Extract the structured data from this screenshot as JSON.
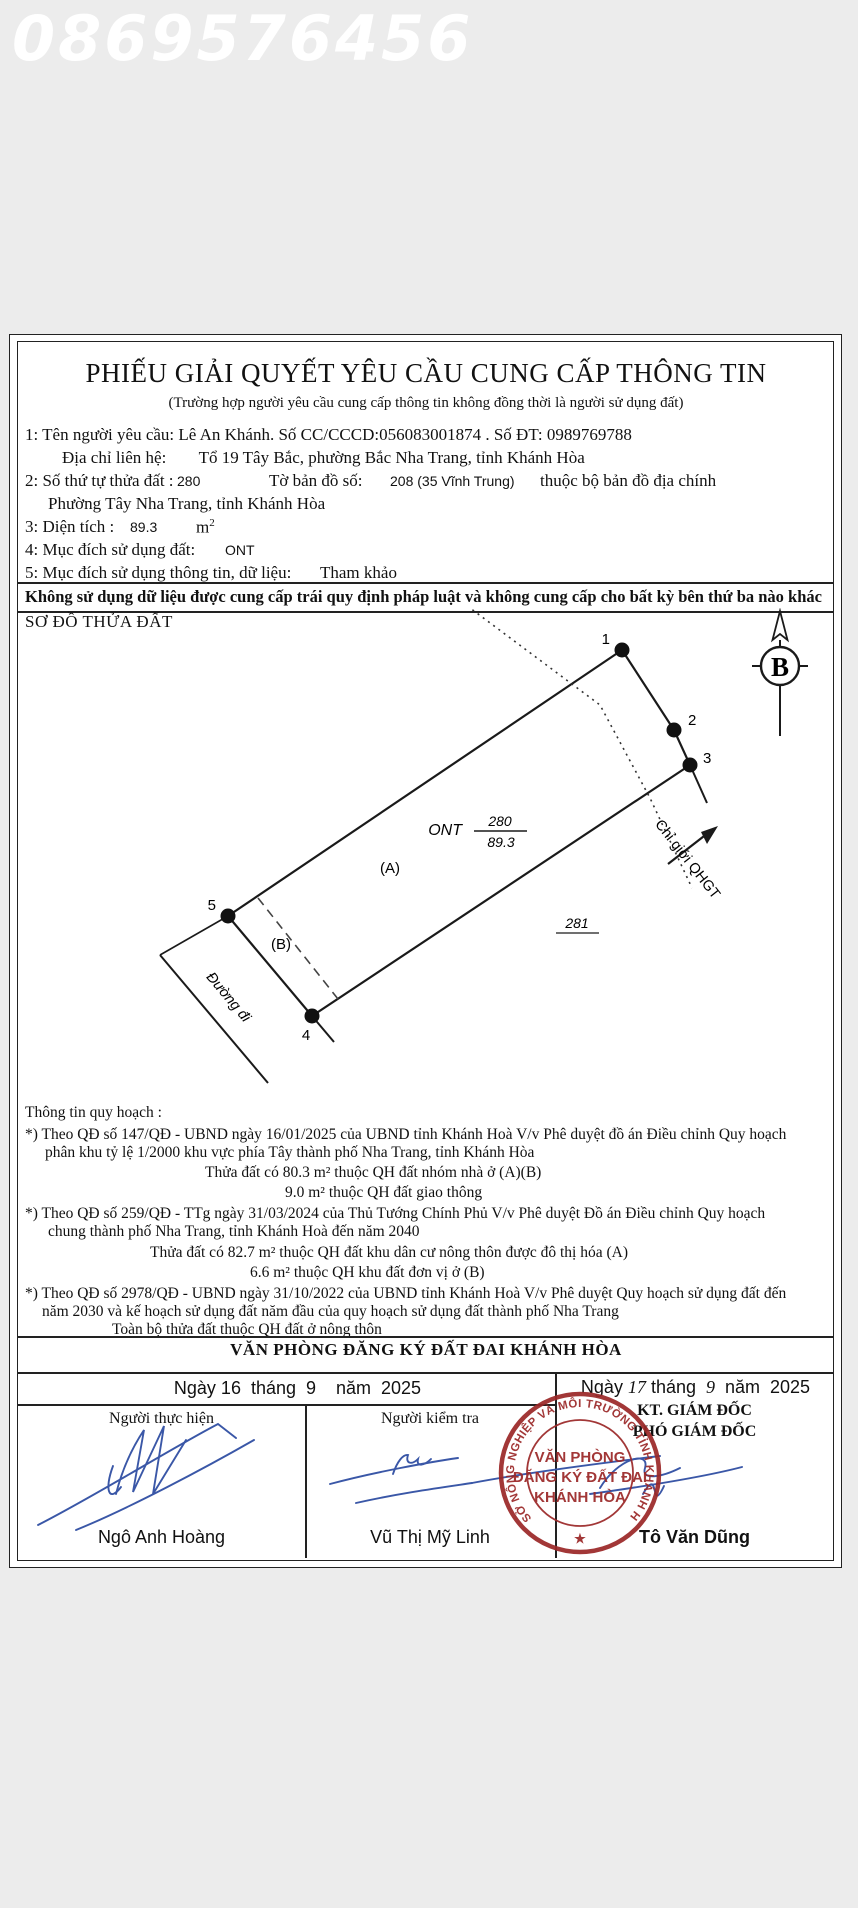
{
  "watermark": "0869576456",
  "doc": {
    "title": "PHIẾU GIẢI QUYẾT YÊU CẦU CUNG CẤP THÔNG TIN",
    "subtitle": "(Trường hợp người yêu cầu cung cấp thông tin không đồng thời là người sử dụng đất)",
    "fields": {
      "requester": "1: Tên người yêu cầu: Lê An Khánh. Số CC/CCCD:056083001874 . Số ĐT: 0989769788",
      "address_label": "Địa chỉ liên hệ:",
      "address_value": "Tổ 19 Tây Bắc, phường Bắc Nha Trang, tỉnh Khánh Hòa",
      "parcel_label": "2: Số thứ tự thửa đất :",
      "parcel_number": "280",
      "sheet_label": "Tờ bản đồ số:",
      "sheet_number": "208 (35 Vĩnh Trung)",
      "sheet_suffix": "thuộc bộ bản đồ địa chính",
      "parcel_address": "Phường Tây Nha Trang, tỉnh Khánh Hòa",
      "area_label": "3: Diện tích :",
      "area_value": "89.3",
      "area_unit": "m",
      "area_unit_sup": "2",
      "landuse_label": "4: Mục đích sử dụng đất:",
      "landuse_value": "ONT",
      "purpose_label": "5: Mục đích sử dụng thông tin, dữ liệu:",
      "purpose_value": "Tham khảo",
      "disclaimer": "Không sử dụng dữ liệu được cung cấp trái quy định pháp luật và không cung cấp cho bất kỳ bên thứ ba nào khác"
    },
    "diagram": {
      "heading": "SƠ ĐỒ THỬA ĐẤT",
      "north_label": "B",
      "point1": "1",
      "point2": "2",
      "point3": "3",
      "point4": "4",
      "point5": "5",
      "landuse_code": "ONT",
      "parcel_number": "280",
      "parcel_area": "89.3",
      "zone_a": "(A)",
      "zone_b": "(B)",
      "neighbor_parcel": "281",
      "boundary_label": "Chỉ giới QHGT",
      "road_label": "Đường đi"
    },
    "planning": {
      "heading": "Thông tin quy hoạch :",
      "lines": [
        "*) Theo QĐ số 147/QĐ - UBND ngày 16/01/2025 của UBND tỉnh Khánh Hoà V/v Phê duyệt đồ án Điều chỉnh Quy hoạch",
        "phân khu tỷ lệ 1/2000 khu vực phía Tây thành phố Nha Trang, tỉnh Khánh Hòa",
        "Thửa đất có 80.3 m² thuộc QH đất nhóm nhà ở (A)(B)",
        "9.0 m² thuộc QH đất giao thông",
        "*) Theo QĐ số 259/QĐ - TTg ngày 31/03/2024 của Thủ Tướng Chính Phủ V/v Phê duyệt Đồ án Điều chỉnh Quy hoạch",
        "chung thành phố Nha Trang, tỉnh Khánh Hoà đến năm 2040",
        "Thửa đất có 82.7 m² thuộc QH đất khu dân cư nông thôn được đô thị hóa (A)",
        "6.6 m² thuộc QH khu đất đơn vị ở (B)",
        "*) Theo QĐ số 2978/QĐ - UBND ngày 31/10/2022 của UBND tỉnh Khánh Hoà V/v Phê duyệt Quy hoạch sử dụng đất đến",
        "năm 2030 và kế hoạch sử dụng đất năm đầu của quy hoạch sử dụng đất thành phố Nha Trang",
        "Toàn bộ thửa đất thuộc QH đất ở nông thôn"
      ]
    },
    "footer": {
      "office": "VĂN PHÒNG ĐĂNG KÝ ĐẤT ĐAI KHÁNH HÒA",
      "date_left": "Ngày 16  tháng  9    năm  2025",
      "date_right_prefix": "Ngày ",
      "date_right_day": "17",
      "date_right_mid": " tháng  ",
      "date_right_month": "9",
      "date_right_suffix": "  năm  2025",
      "executor_title": "Người thực hiện",
      "checker_title": "Người kiểm tra",
      "signer_title1": "KT. GIÁM ĐỐC",
      "signer_title2": "PHÓ GIÁM ĐỐC",
      "executor_name": "Ngô Anh Hoàng",
      "checker_name": "Vũ Thị Mỹ Linh",
      "signer_name": "Tô Văn Dũng",
      "stamp": {
        "ring_text": "SỞ NÔNG NGHIỆP VÀ MÔI TRƯỜNG TỈNH KHÁNH HÒA",
        "star": "★",
        "line1": "VĂN PHÒNG",
        "line2": "ĐĂNG KÝ ĐẤT ĐAI",
        "line3": "KHÁNH HÒA"
      }
    },
    "colors": {
      "stamp_red": "#9b2828",
      "ink_blue": "#3a57a7"
    }
  }
}
